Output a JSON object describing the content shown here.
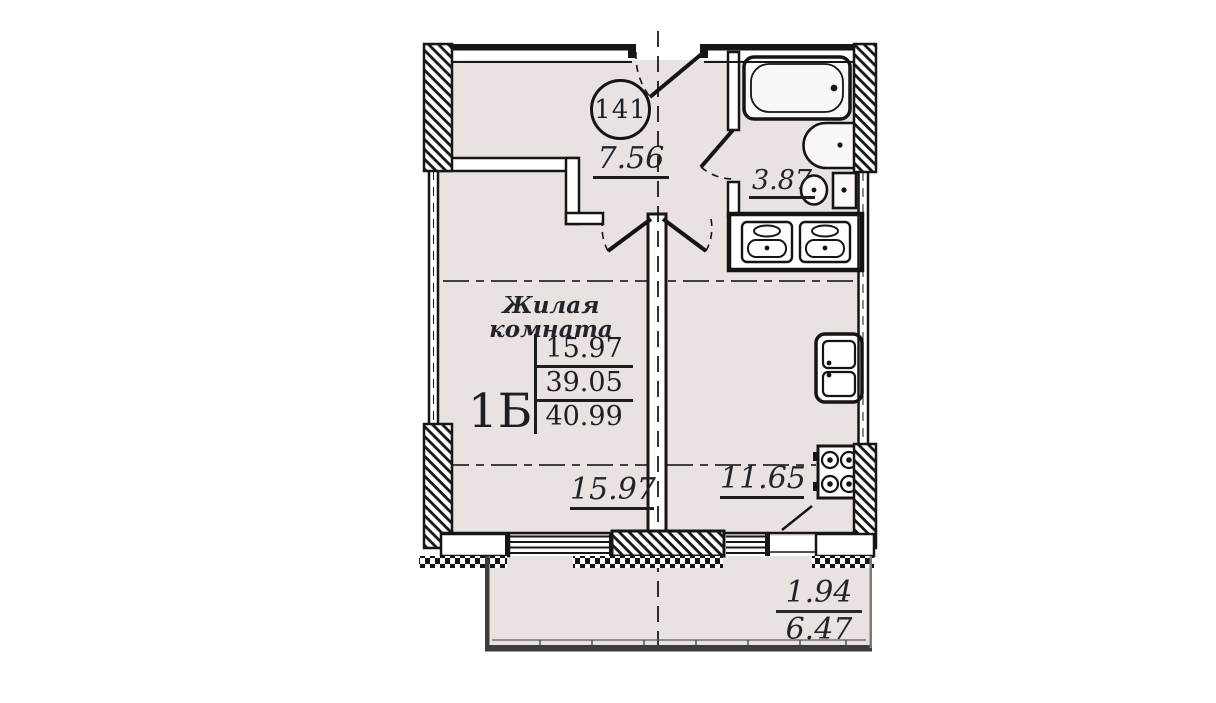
{
  "palette": {
    "floor_fill": "#EAE2E1",
    "wall_line": "#161616",
    "text": "#23232B",
    "balcony_edge": "#3D3D3D"
  },
  "plan": {
    "apartment_number": "141",
    "stamp": {
      "type": "1Б",
      "values": [
        "15.97",
        "39.05",
        "40.99"
      ]
    },
    "rooms": {
      "hall": {
        "area": "7.56"
      },
      "bathroom": {
        "area": "3.87"
      },
      "living": {
        "name": "Жилая комната",
        "area": "15.97"
      },
      "kitchen": {
        "area": "11.65"
      },
      "balcony": {
        "coefficient_area": "1.94",
        "full_area": "6.47"
      }
    },
    "icons": {
      "bathtub": "rounded-rect-with-drain-dot",
      "washbasin": "half-oval-on-wall",
      "toilet": "bowl-circle-with-tank",
      "vent_shaft": "boxed-duct-pair",
      "kitchen_sink": "double-bowl-rect",
      "stove": "four-burner-rings",
      "door_swing": "leaf-with-dashed-arc",
      "window": "parallel-lines",
      "bearing_wall": "diagonal-hatch",
      "insulation": "checkerboard-strip"
    }
  }
}
